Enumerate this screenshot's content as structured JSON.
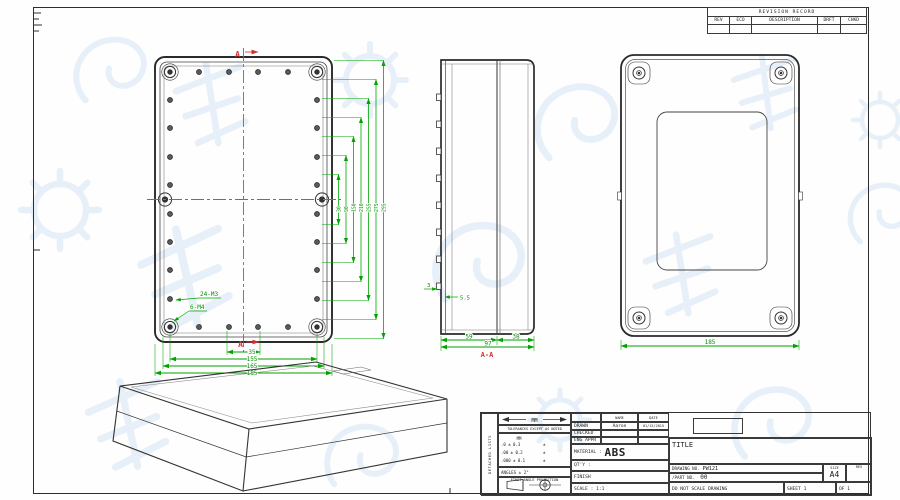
{
  "revision_table": {
    "title": "REVISION RECORD",
    "col_rev": "REV",
    "col_eco": "ECO",
    "col_description": "DESCRIPTION",
    "col_drft": "DRFT",
    "col_chkd": "CHKD"
  },
  "front_view": {
    "section_label_top": "A",
    "section_label_bottom": "A",
    "thread_label_holes": "24-M3",
    "thread_label_posts": "6-M4",
    "dim_35": "35",
    "dim_155": "155",
    "dim_165": "165",
    "dim_185": "185",
    "right_dims": [
      "30",
      "90",
      "150",
      "210",
      "255",
      "275",
      "295"
    ]
  },
  "side_view": {
    "dim_base": "59",
    "dim_lid": "38",
    "dim_total": "97",
    "section_label": "A-A",
    "dim_wall": "3",
    "dim_boss": "5.5"
  },
  "back_view": {
    "dim_width": "185"
  },
  "title_block": {
    "side_label": "DETACHED LISTS",
    "units_label": "MM",
    "tolerance_note": "TOLERANCES EXCEPT AS NOTED",
    "tol_header": "MM",
    "tol_rows": [
      ".0 ± 0.3",
      ".00 ± 0.2",
      ".000 ± 0.1"
    ],
    "tol_marks": [
      "±",
      "±",
      "±"
    ],
    "angles_note": "ANGLES ± 2°",
    "projection_note": "FIRST ANGLE PROJECTION",
    "name_header": "NAME",
    "date_header": "DATE",
    "drawn_label": "DRAWN",
    "drawn_name": "Aaron",
    "drawn_date": "01/15/2015",
    "checked_label": "CHECKED",
    "eng_appr_label": "ENG APPR",
    "material_label": "MATERIAL :",
    "material_value": "ABS",
    "qty_label": "QT'Y :",
    "finish_label": "FINISH",
    "scale_label": "SCALE : 1:1",
    "title_label": "TITLE",
    "drawing_no_label": "DRAWING NO.",
    "drawing_no_value": "PW121",
    "part_no_label": "/PART NO.",
    "part_no_value": "00",
    "size_label": "SIZE",
    "size_value": "A4",
    "rev_label": "REV",
    "no_scale_note": "DO NOT SCALE DRAWING",
    "sheet_label": "SHEET 1",
    "sheet_of": "OF 1"
  }
}
